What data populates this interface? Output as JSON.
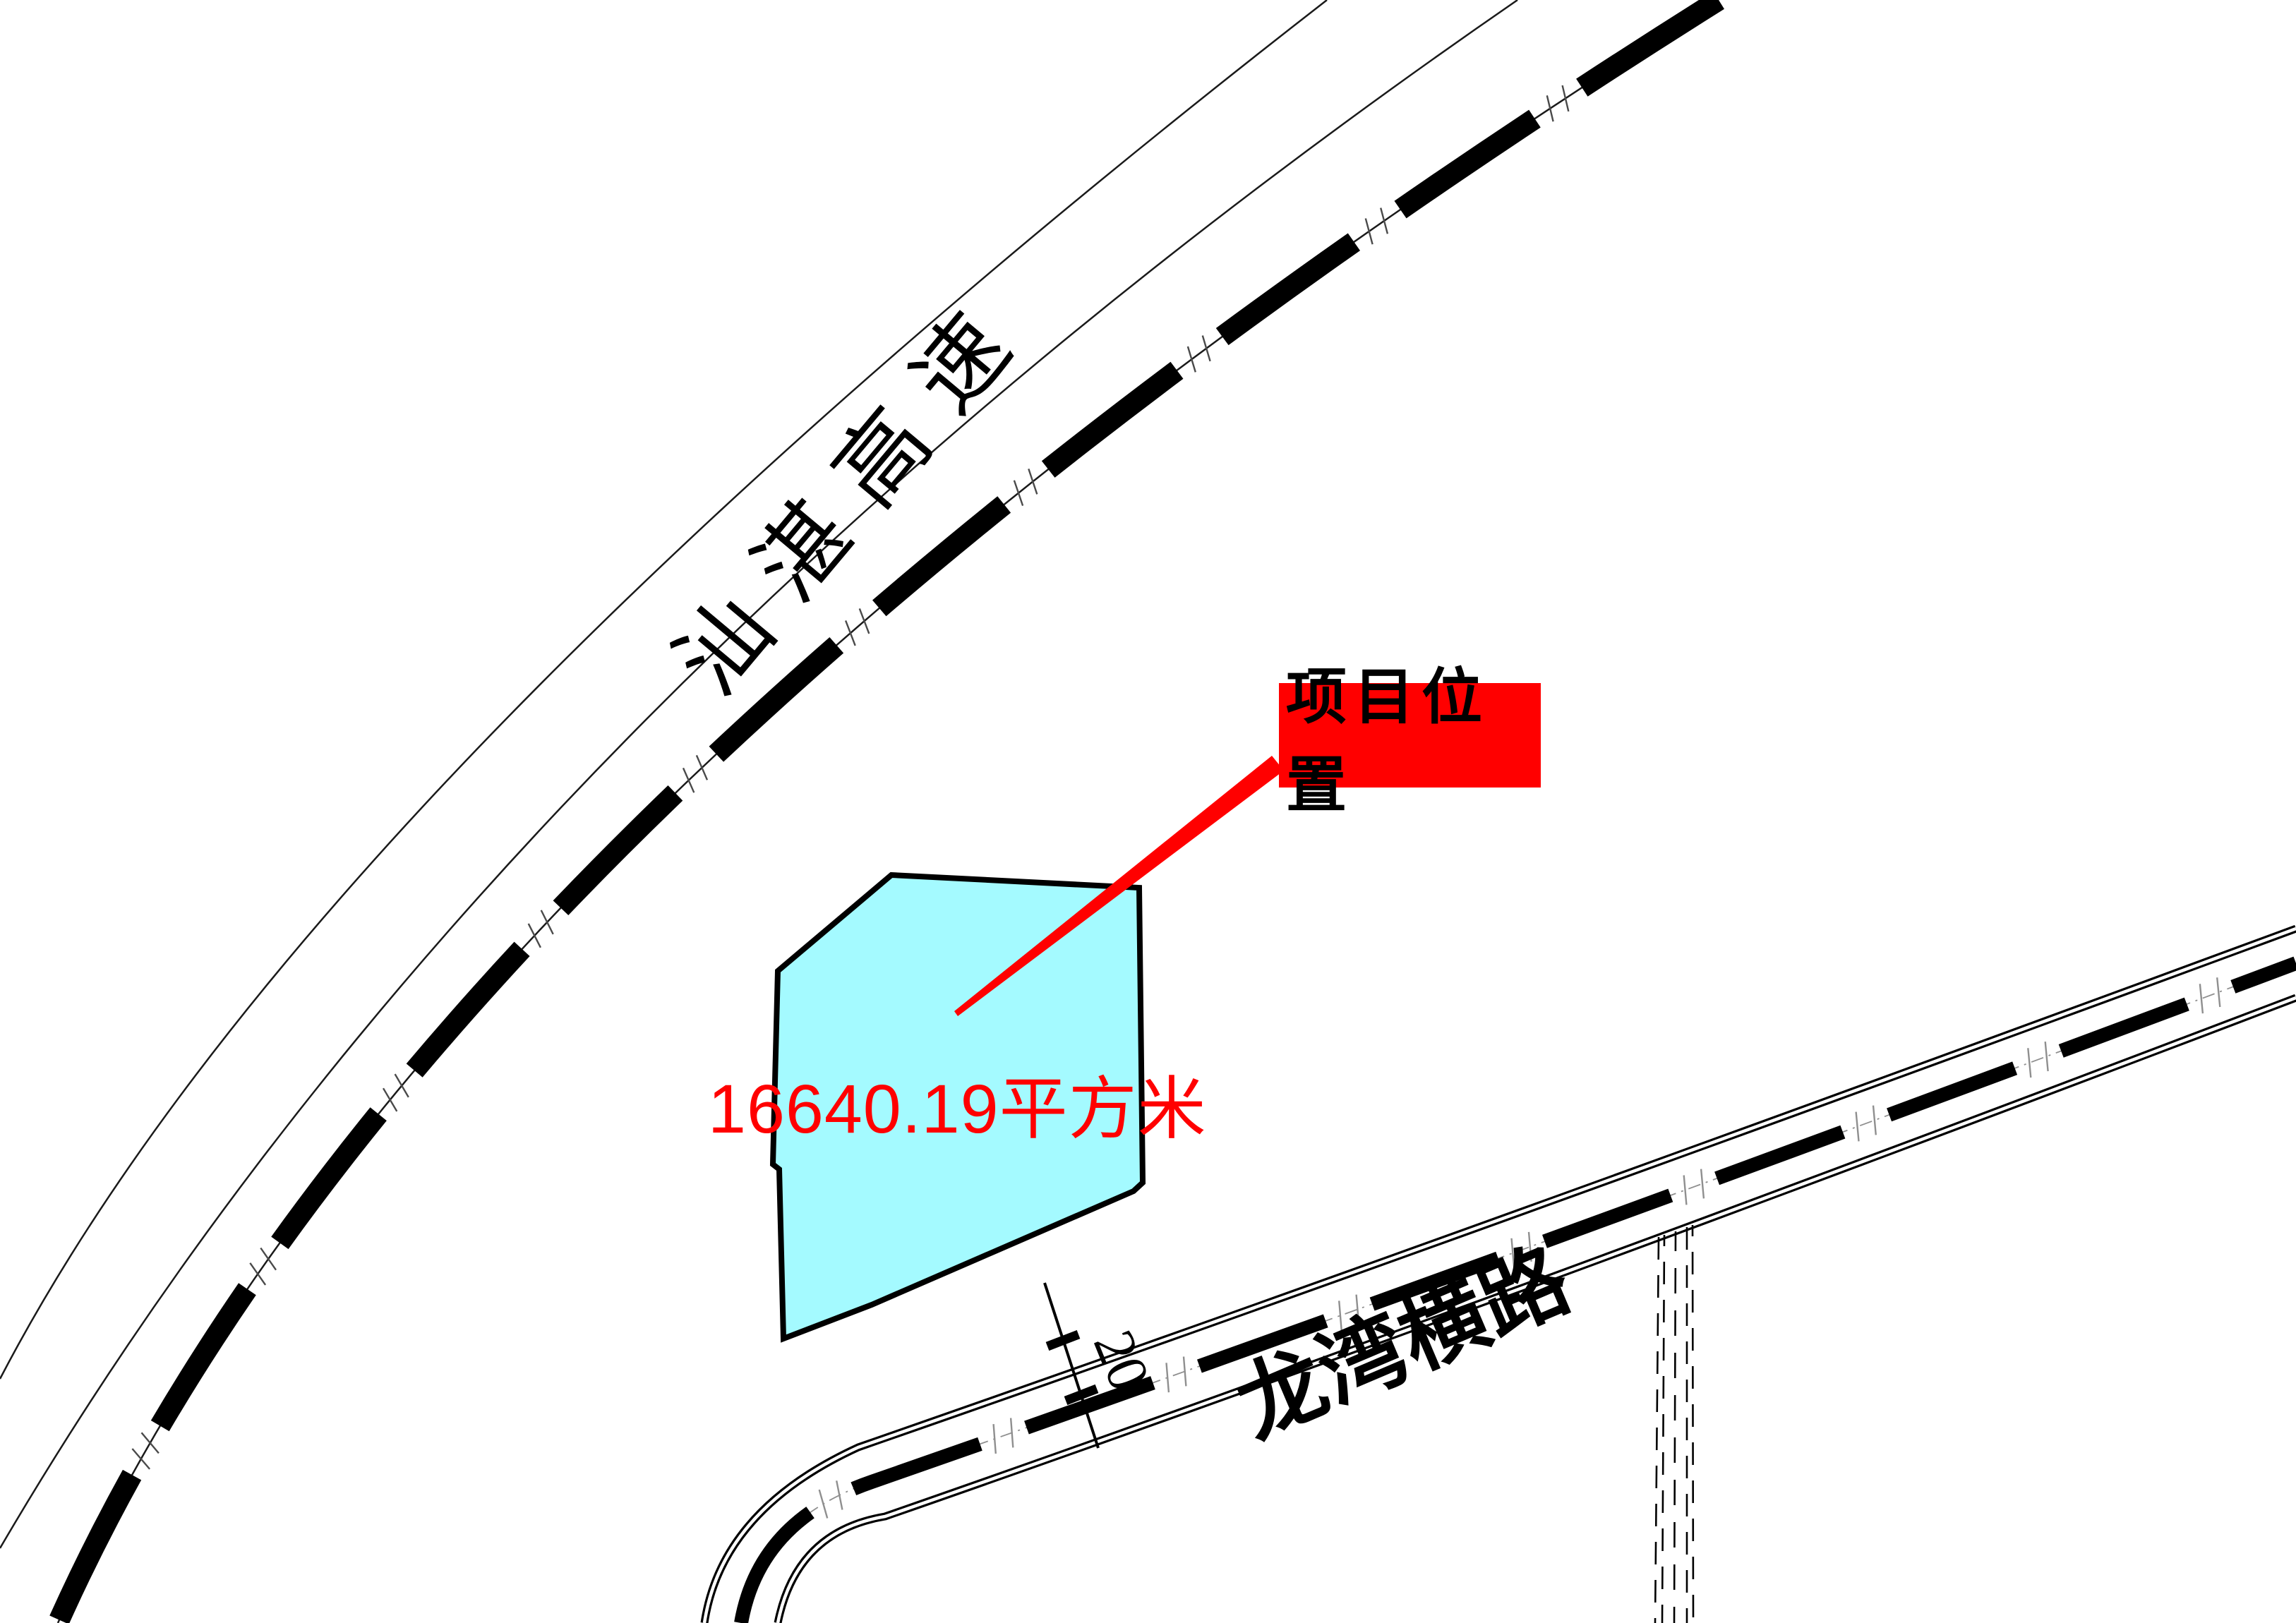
{
  "map": {
    "expressway": {
      "label": "汕湛高速"
    },
    "road": {
      "label": "龙湾横路",
      "width_dimension": "20"
    },
    "parcel": {
      "area_label": "16640.19平方米"
    },
    "callout": {
      "label": "项目位置"
    },
    "colors": {
      "highlight_red": "#FF0000",
      "parcel_fill": "#A4FAFF",
      "ink_black": "#000000",
      "tick_gray": "#8f8f8f"
    }
  }
}
